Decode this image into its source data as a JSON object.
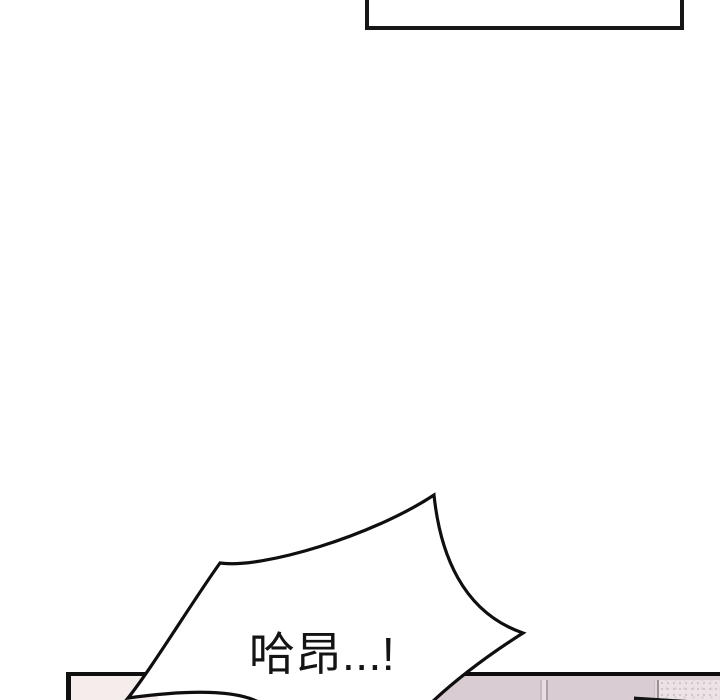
{
  "page": {
    "background": "#ffffff",
    "description": "webtoon comic page segment, white gutter between panels"
  },
  "top_panel": {
    "border_color": "#161616",
    "fill": "#ffffff"
  },
  "speech_bubble": {
    "text": "哈昂...!",
    "text_color": "#141414",
    "fill": "#ffffff",
    "outline_color": "#0f0f0f"
  },
  "bottom_panel": {
    "left_wall": {
      "fill": "#f4edeb",
      "border_color": "#101010"
    },
    "tile_wall": {
      "fill": "#d9cdd3",
      "border_color": "#0d0d0d",
      "grout_light": "#e6dee2",
      "grout_dark": "#aca0a8",
      "frost_shadow_line": "#9a8f96"
    },
    "frosted_glass": {
      "fill": "#ebe3e5",
      "speckle": "#d0c4ca"
    },
    "dark_wedge_color": "#141414"
  }
}
